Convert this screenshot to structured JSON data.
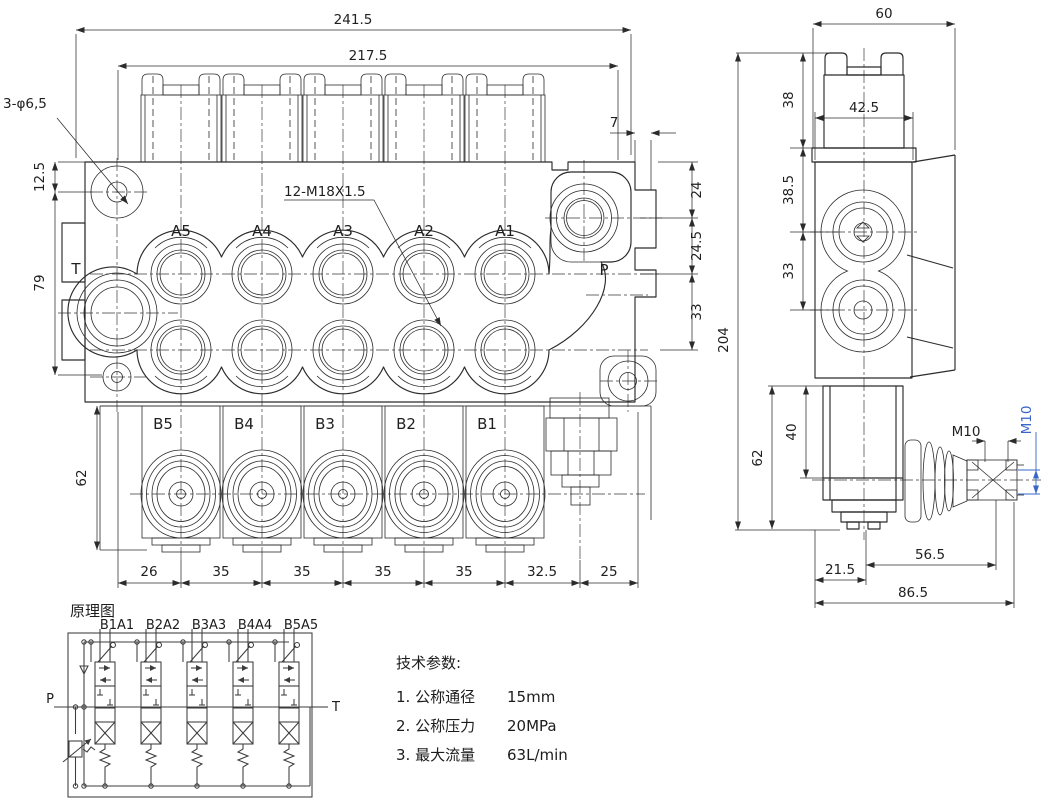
{
  "colors": {
    "line": "#2b2b2b",
    "text": "#1f1f1f",
    "accent_blue": "#3a66c8",
    "background": "#ffffff"
  },
  "front_view": {
    "dim_overall_width": "241.5",
    "dim_cap_span": "217.5",
    "hole_callout": "3-φ6,5",
    "dim_hole_offset": "12.5",
    "dim_hole_spacing": "79",
    "thread_callout": "12-M18X1.5",
    "dim_notch": "7",
    "dim_right_top": "24",
    "dim_right_mid": "24.5",
    "dim_right_bot": "33",
    "dim_lower_height": "62",
    "ports_a": [
      "A5",
      "A4",
      "A3",
      "A2",
      "A1"
    ],
    "ports_b": [
      "B5",
      "B4",
      "B3",
      "B2",
      "B1"
    ],
    "port_t": "T",
    "port_p": "P",
    "chain": [
      "26",
      "35",
      "35",
      "35",
      "35",
      "32.5",
      "25"
    ]
  },
  "side_view": {
    "dim_width": "60",
    "dim_cap_width": "42.5",
    "dim_cap_height": "38",
    "dim_upper": "38.5",
    "dim_port_spacing": "33",
    "dim_overall_height": "204",
    "dim_bracket_40": "40",
    "dim_bracket_62": "62",
    "thread_horizontal": "M10",
    "thread_vertical": "M10",
    "dim_lever_56": "56.5",
    "dim_lever_21": "21.5",
    "dim_lever_86": "86.5"
  },
  "schematic": {
    "title": "原理图",
    "section_labels": [
      "B1A1",
      "B2A2",
      "B3A3",
      "B4A4",
      "B5A5"
    ],
    "port_p": "P",
    "port_t": "T"
  },
  "tech_params": {
    "title": "技术参数:",
    "items": [
      {
        "label": "1. 公称通径",
        "value": "15mm"
      },
      {
        "label": "2. 公称压力",
        "value": "20MPa"
      },
      {
        "label": "3. 最大流量",
        "value": "63L/min"
      }
    ]
  }
}
